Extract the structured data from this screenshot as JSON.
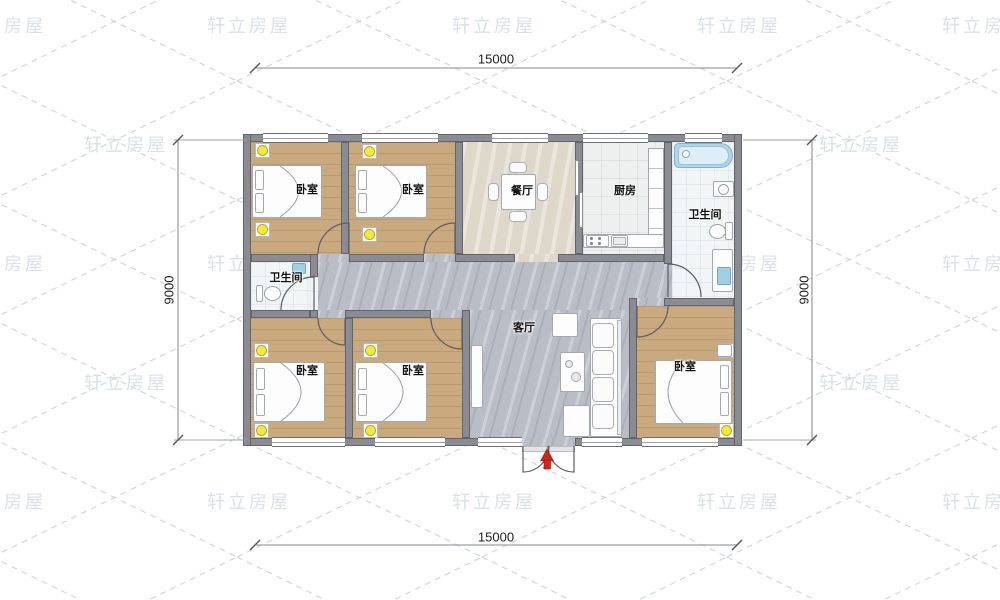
{
  "watermark": {
    "text": "轩立房屋"
  },
  "rooms": {
    "bedroom": "卧室",
    "dining_room": "餐厅",
    "kitchen": "厨房",
    "bathroom": "卫生间",
    "living_room": "客厅"
  },
  "dimensions": {
    "width_mm": "15000",
    "depth_mm": "9000"
  },
  "symbols": {
    "lamp": "ceiling-lamp-symbol",
    "entry_arrow": "entry-direction-arrow",
    "window": "window-symbol",
    "door": "door-swing-symbol",
    "sliding_door": "sliding-door-symbol"
  },
  "colors": {
    "wall": "#8b8b93",
    "wood_floor": "#c9a97e",
    "marble_floor": "#b9bdc5",
    "dining_floor": "#ded8ca",
    "kitchen_floor": "#edf0ef",
    "bath_floor": "#f2f5f6",
    "lamp_accent": "#f4e93d",
    "entry_arrow": "#d3261a",
    "bathtub": "#aed6ea",
    "watermark": "#dbe0ea"
  }
}
